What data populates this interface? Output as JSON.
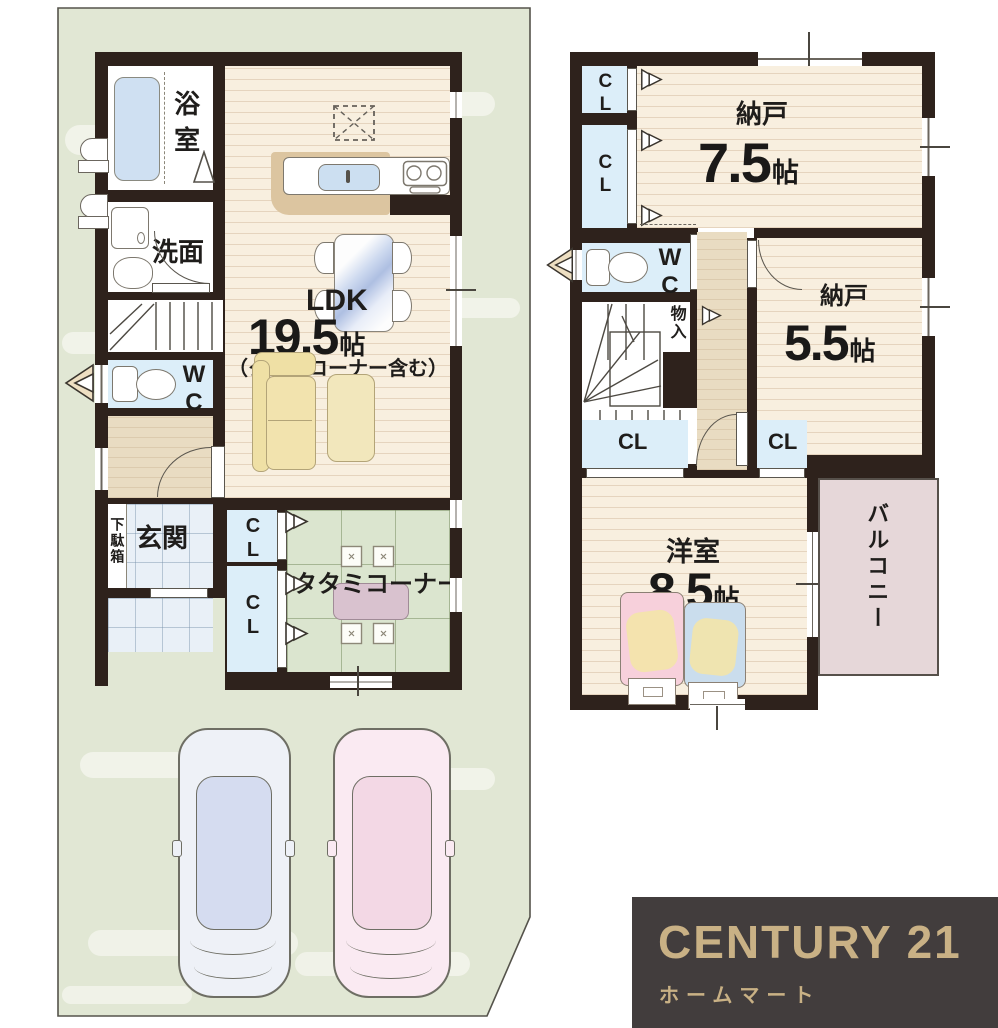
{
  "colors": {
    "wall": "#2e221c",
    "wood_floor": "#f8efdf",
    "tatami_green": "#dbe5cf",
    "closet_blue": "#dceef9",
    "balcony_pink": "#e6d7d9",
    "lot_green": "#e1e7d4",
    "car_blue": "#d5dcf0",
    "car_pink": "#f3d8e5",
    "logo_background": "#423d3d",
    "logo_gold": "#c9b185"
  },
  "floor1": {
    "bath_label": "浴室",
    "washroom_label": "洗面",
    "wc_label": "WC",
    "ldk_label": "LDK",
    "ldk_size_value": "19.5",
    "ldk_size_unit": "帖",
    "ldk_note": "（タタミコーナー含む）",
    "entrance_label": "玄関",
    "shoe_cabinet_label": "下駄箱",
    "closet_upper_label": "CL",
    "closet_lower_label": "CL",
    "tatami_corner_label": "タタミコーナー"
  },
  "floor2": {
    "closet_top_label": "CL",
    "closet_mid_label": "CL",
    "storage1_label": "納戸",
    "storage1_size_value": "7.5",
    "storage1_size_unit": "帖",
    "wc_label": "WC",
    "small_storage_label": "物入",
    "storage2_label": "納戸",
    "storage2_size_value": "5.5",
    "storage2_size_unit": "帖",
    "closet_bottom_left_label": "CL",
    "closet_bottom_right_label": "CL",
    "western_room_label": "洋室",
    "western_room_size_value": "8.5",
    "western_room_size_unit": "帖",
    "balcony_label": "バルコニー"
  },
  "logo": {
    "brand": "CENTURY 21",
    "company_name": "ホームマート"
  }
}
